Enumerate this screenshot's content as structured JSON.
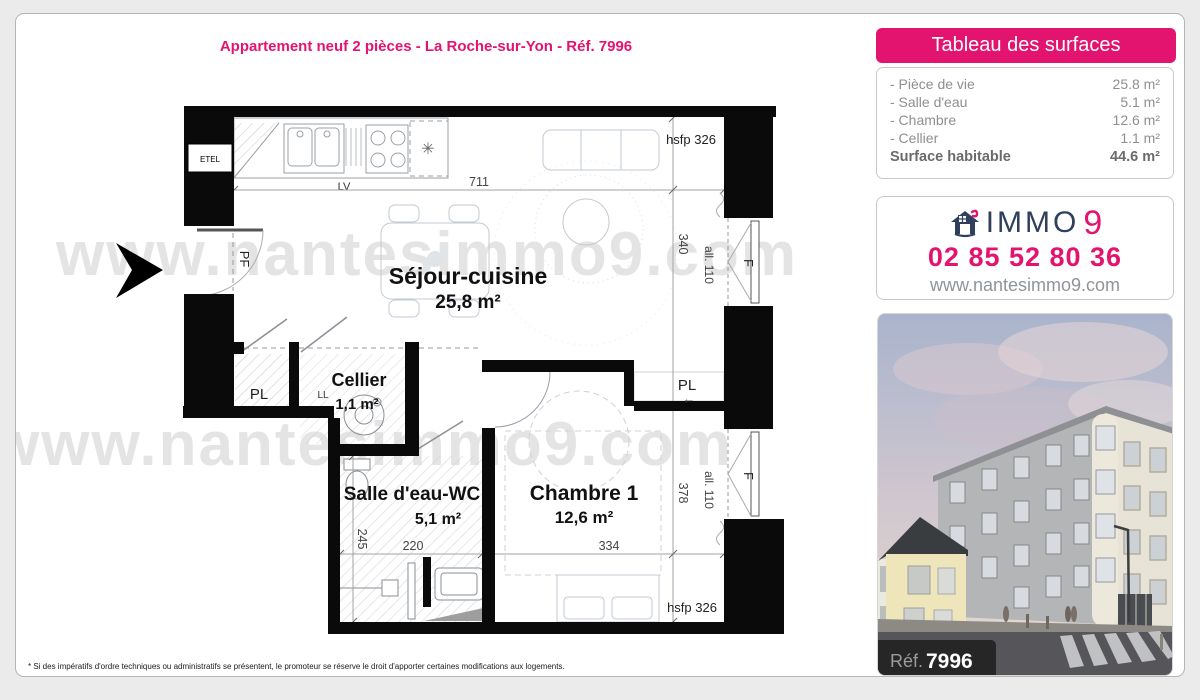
{
  "title": "Appartement neuf 2 pièces - La Roche-sur-Yon - Réf. 7996",
  "surfaces_panel": {
    "header": "Tableau des surfaces",
    "rows": [
      {
        "label": "- Pièce de vie",
        "value": "25.8 m²"
      },
      {
        "label": "- Salle d'eau",
        "value": "5.1 m²"
      },
      {
        "label": "- Chambre",
        "value": "12.6 m²"
      },
      {
        "label": "- Cellier",
        "value": "1.1 m²"
      }
    ],
    "total_label": "Surface habitable",
    "total_value": "44.6 m²"
  },
  "agency": {
    "brand_text": "IMMO",
    "brand_number": "9",
    "phone": "02 85 52 80 36",
    "website": "www.nantesimmo9.com"
  },
  "photo": {
    "ref_label": "Réf.",
    "ref_number": "7996"
  },
  "watermark": {
    "text": "www.nantesimmo9.com"
  },
  "footnote": "* Si des impératifs d'ordre techniques ou administratifs se présentent, le promoteur se réserve le droit d'apporter certaines modifications aux logements.",
  "plan": {
    "rooms": {
      "sejour": {
        "name": "Séjour-cuisine",
        "area": "25,8 m²"
      },
      "cellier": {
        "name": "Cellier",
        "area": "1,1 m²"
      },
      "salle_eau": {
        "name": "Salle d'eau-WC",
        "area": "5,1 m²"
      },
      "chambre": {
        "name": "Chambre 1",
        "area": "12,6 m²"
      }
    },
    "labels": {
      "pl_left": "PL",
      "pl_right": "PL",
      "ll": "LL",
      "lv": "LV",
      "etel": "ETEL",
      "pf": "PF",
      "f_top": "F",
      "f_bottom": "F",
      "arrow_left": "←",
      "star": "✳"
    },
    "dims": {
      "w711": "711",
      "h340": "340",
      "h378": "378",
      "w334": "334",
      "w220": "220",
      "h245": "245",
      "all110_a": "all. 110",
      "all110_b": "all. 110",
      "hsfp_top": "hsfp 326",
      "hsfp_bottom": "hsfp 326"
    }
  },
  "colors": {
    "accent_pink": "#e3146f",
    "brand_navy": "#2f3f5c",
    "page_bg": "#ebebeb"
  }
}
